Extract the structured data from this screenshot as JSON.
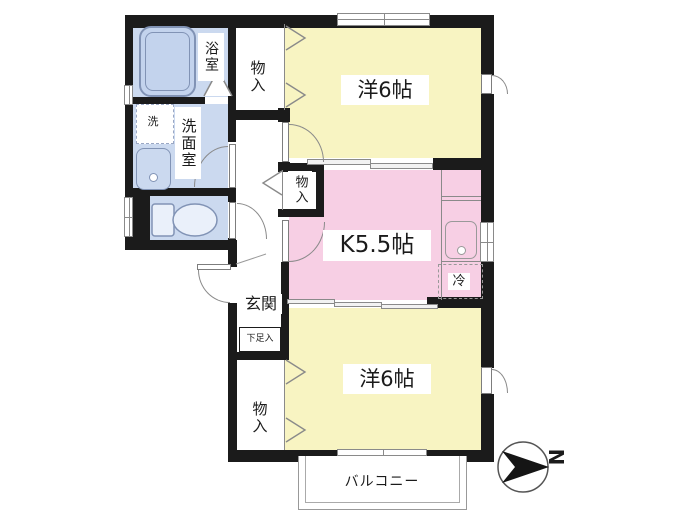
{
  "rooms": {
    "bath": {
      "label": "浴室"
    },
    "washroom": {
      "label": "洗面室"
    },
    "washing_machine": {
      "label": "洗"
    },
    "closet_top": {
      "label": "物入"
    },
    "closet_middle": {
      "label": "物入"
    },
    "closet_bottom": {
      "label": "物入"
    },
    "western_room_top": {
      "label": "洋6帖"
    },
    "kitchen": {
      "label": "K5.5帖"
    },
    "refrigerator": {
      "label": "冷"
    },
    "entrance": {
      "label": "玄関"
    },
    "shoe_cabinet": {
      "label": "下足入"
    },
    "western_room_bottom": {
      "label": "洋6帖"
    },
    "balcony": {
      "label": "バルコニー"
    }
  },
  "compass": {
    "north_label": "N"
  },
  "colors": {
    "wall": "#1b1b1b",
    "room_yellow": "#F8F4C2",
    "kitchen_pink": "#F7CFE4",
    "wet_area_blue": "#CBD9EF",
    "line_gray": "#8a8a8a"
  }
}
